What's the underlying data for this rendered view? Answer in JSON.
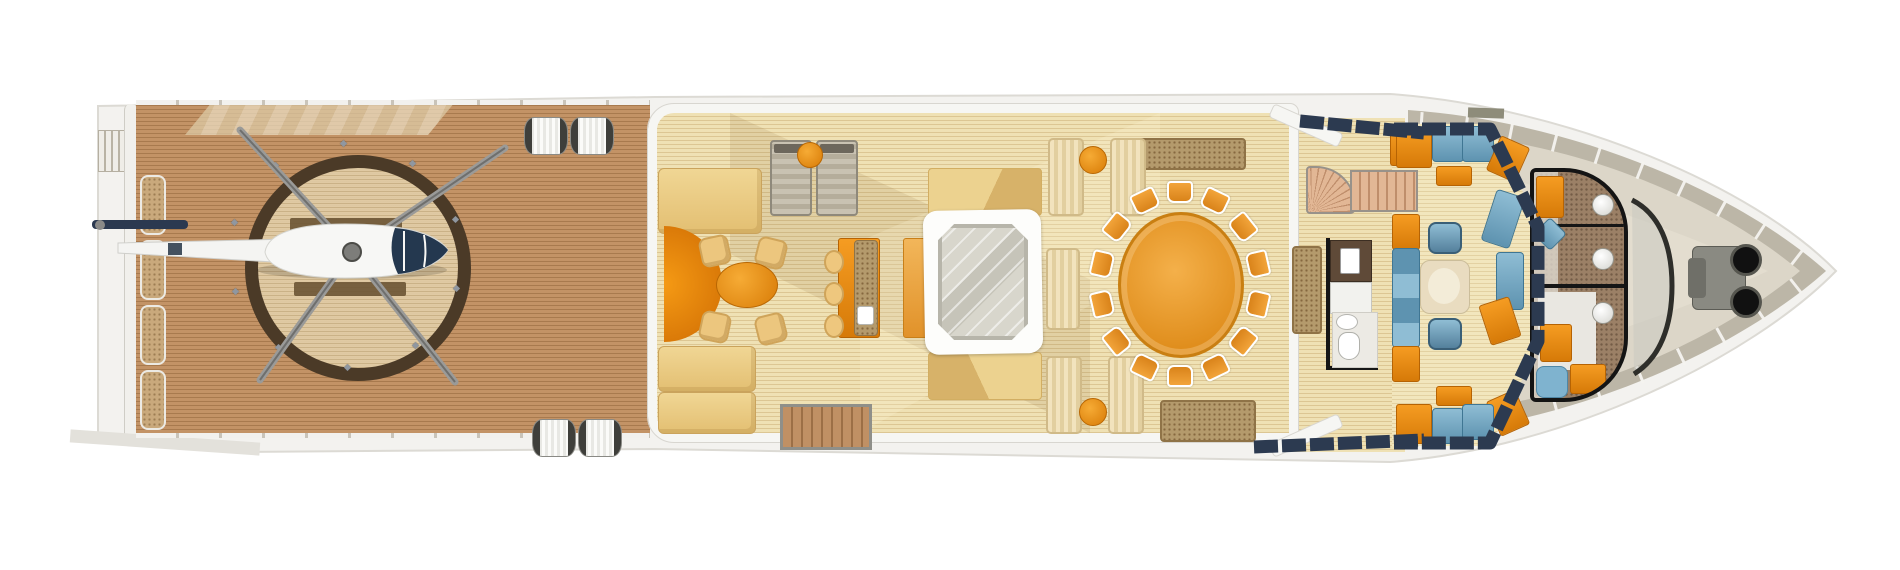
{
  "meta": {
    "title": "Superyacht main deck plan — top view",
    "type": "deck-plan"
  },
  "palette": {
    "teak": "#c39366",
    "teak_stripe": "#a87a4e",
    "helipad_ring": "#4b3a27",
    "h_mark": "#6b5434",
    "floor": "#efe1b4",
    "floor_stripe": "#dcc693",
    "wall": "#f6f6f3",
    "wall_edge": "#d8d6d0",
    "sofa_beige_1": "#f0d694",
    "sofa_beige_2": "#e3bf72",
    "orange": "#f09416",
    "orange_deep": "#cf6c03",
    "table_orange": "#eda43e",
    "blue_1": "#8fbdd4",
    "blue_2": "#5e93b0",
    "navy": "#2c3a50",
    "bow_deck": "#dcd6c8",
    "bulwark": "#bcb6a7",
    "hull": "#f3f2ef",
    "hull_edge": "#dcdad4",
    "granite": "#b49a6c",
    "granite_dot": "#86683f",
    "water": "#d3d1c7",
    "lounger_gray": "#bdb5a3",
    "stair_tread": "#e2b795",
    "stair_tread_dark": "#bf8e6b",
    "mosaic": "#9b8066",
    "steel": "#8a8a82",
    "black": "#161616",
    "cream_rib_1": "#f2e3bd",
    "cream_rib_2": "#e2cf9f"
  },
  "helipad": {
    "cleat_count": 10,
    "cx": 345,
    "cy": 255,
    "radius": 116
  },
  "stern": {
    "fender_count": 4
  },
  "dining": {
    "chair_count": 14,
    "cx": 1178,
    "cy": 282,
    "rx": 80,
    "ry": 92
  },
  "areas": [
    {
      "label": "Stern platform"
    },
    {
      "label": "Helideck"
    },
    {
      "label": "Helicopter"
    },
    {
      "label": "Touch-and-go circle"
    },
    {
      "label": "Mooring winches"
    },
    {
      "label": "Aft lounge"
    },
    {
      "label": "Wet bar"
    },
    {
      "label": "Jacuzzi"
    },
    {
      "label": "Dining salon"
    },
    {
      "label": "Staircase lobby"
    },
    {
      "label": "Observation salon"
    },
    {
      "label": "Day heads"
    },
    {
      "label": "Foredeck"
    },
    {
      "label": "Anchor windlass"
    }
  ]
}
